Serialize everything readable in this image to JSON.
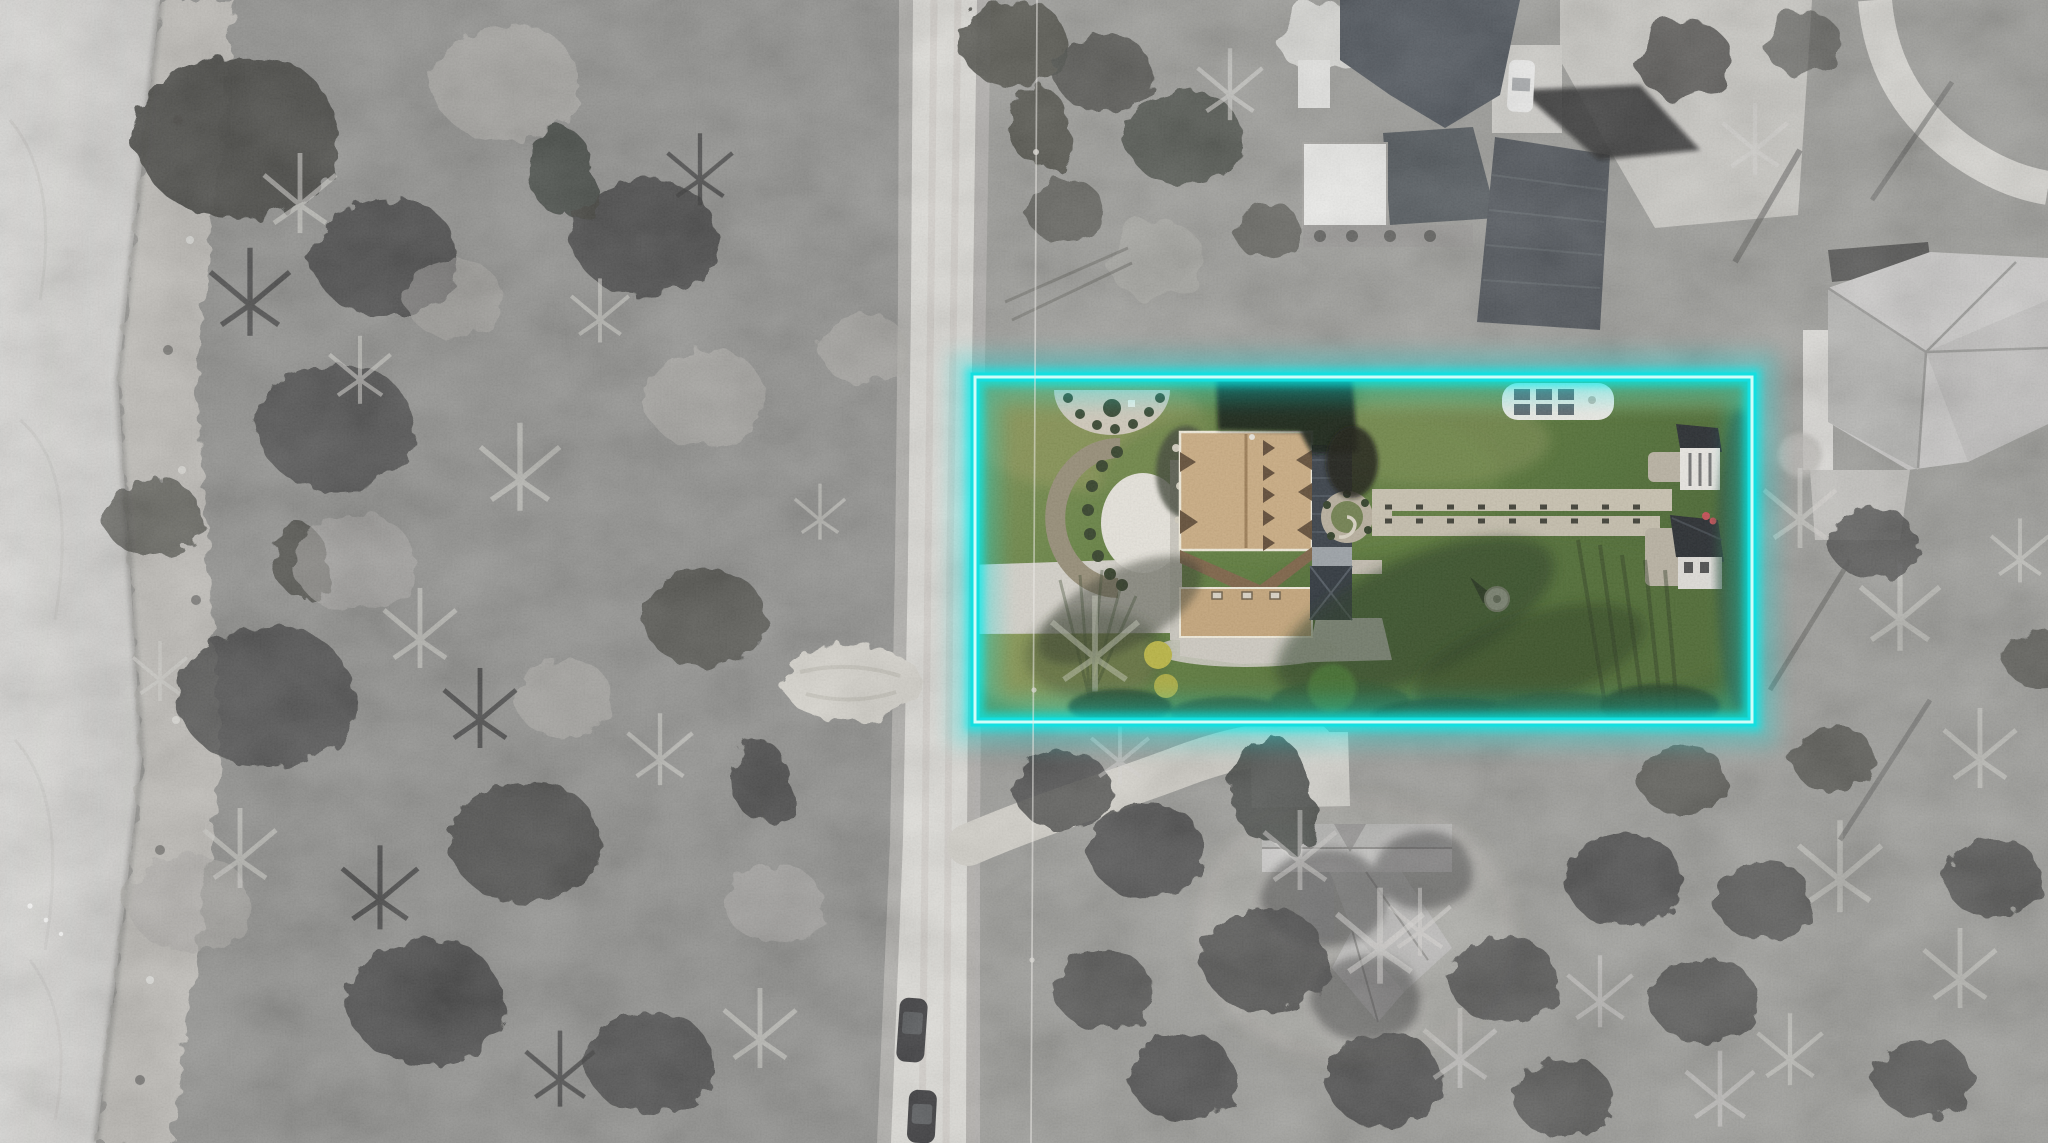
{
  "image": {
    "kind": "aerial-drone-photograph",
    "view": "top-down",
    "effect": "grayscale-surroundings-with-color-highlighted-lot"
  },
  "property_highlight": {
    "shape": "rectangle",
    "style": "neon-glow-outline"
  },
  "counts": {
    "vehicles_on_road": 2,
    "vehicles_at_top_house": 1,
    "outbuildings_in_lot": 2,
    "neighbor_houses": 3
  },
  "colors": {
    "highlight": "#14dfe0",
    "highlight_core": "#d8fefa",
    "highlight_glow": "#00ecec",
    "lawn_green": "#5e7c3b",
    "lawn_olive": "#8a9355",
    "lawn_dark": "#44622c",
    "roof_tan": "#c9aa7f",
    "roof_ridge_brown": "#7a5f42",
    "roof_dark_gray": "#343b43",
    "road_concrete": "#dfddd7",
    "driveway_concrete": "#d3d0c8",
    "path_gravel": "#c7c0ae",
    "water_gray": "#d6d5d2",
    "shore_gray": "#b9b7b1",
    "ground_gray": "#8b8a86",
    "tree_dark_gray": "#2e2e2c",
    "shadow_green": "#22351a",
    "shed_roof_dark": "#22262a",
    "shed_wall_white": "#e8e6e1",
    "pergola_white": "#eceae4",
    "vehicle_white": "#f1f1ef",
    "vehicle_dark": "#1a1b1d",
    "accent_red": "#c2484f"
  }
}
